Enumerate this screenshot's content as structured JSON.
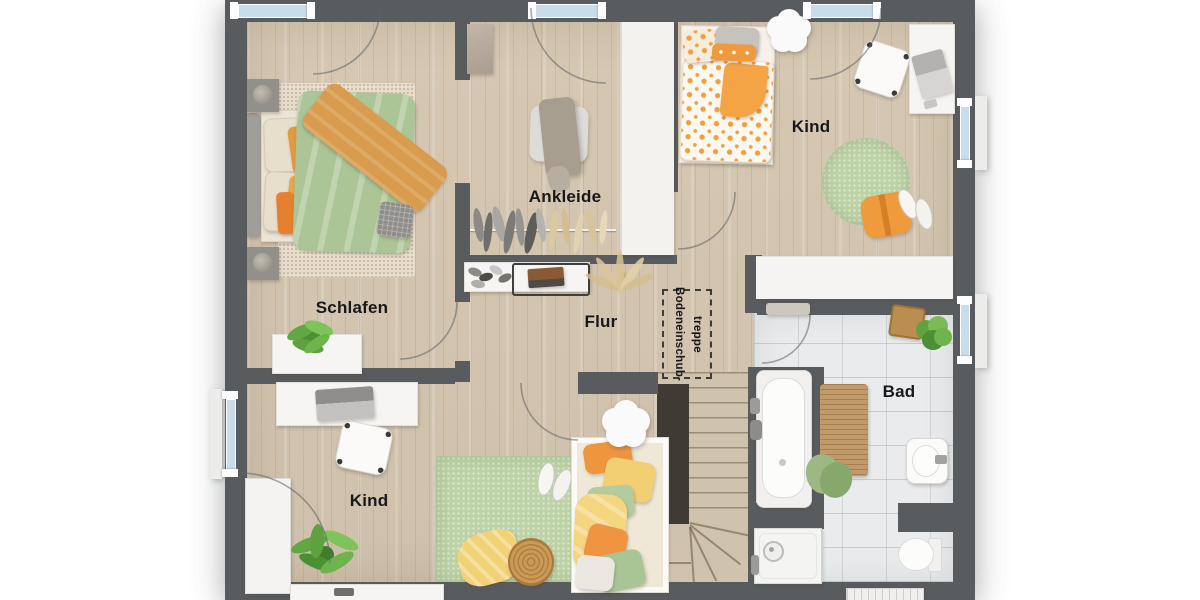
{
  "colors": {
    "wall": "#595c5f",
    "floor_wood": "#d6c9b6",
    "tile": "#e9ebec",
    "window_glass": "#c8dcea",
    "accent_orange": "#ef9a3c",
    "duvet_green": "#abc596",
    "rug_green": "#bdd2a6",
    "label": "#17181a"
  },
  "rooms": {
    "schlafen": {
      "label": "Schlafen"
    },
    "ankleide": {
      "label": "Ankleide"
    },
    "flur": {
      "label": "Flur"
    },
    "kind_top_right": {
      "label": "Kind"
    },
    "kind_bottom_left": {
      "label": "Kind"
    },
    "bad": {
      "label": "Bad"
    },
    "attic_hatch": {
      "label_line1": "Bodeneinschub-",
      "label_line2": "treppe"
    }
  }
}
